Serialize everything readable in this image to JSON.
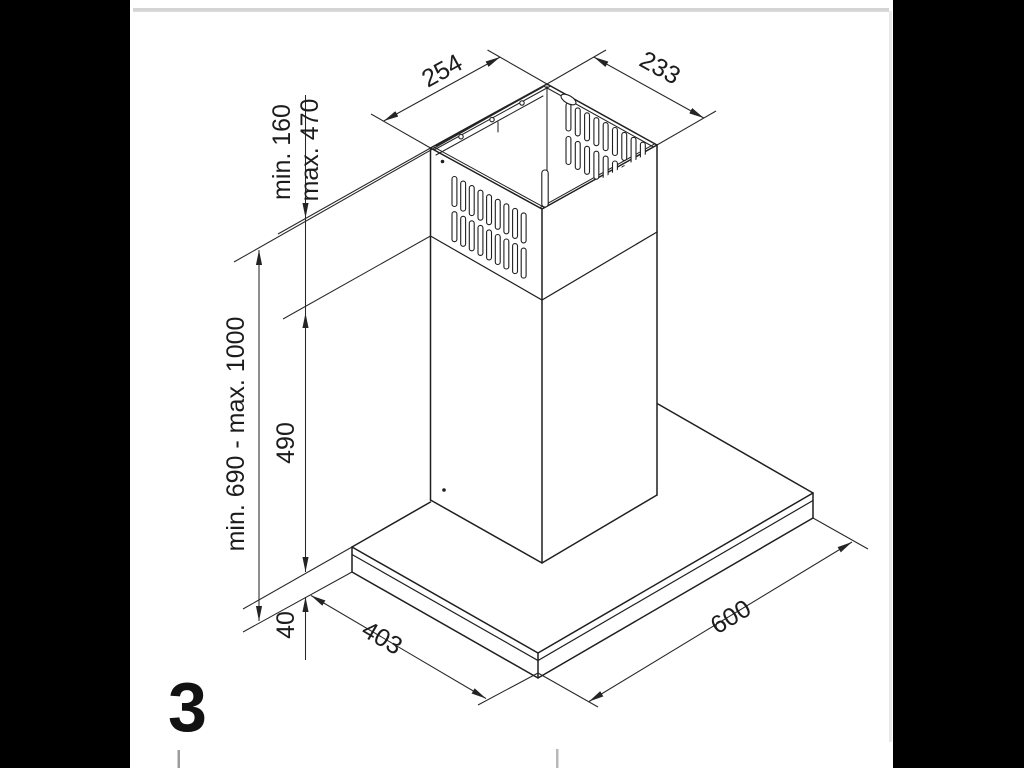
{
  "page": {
    "figure_number": "3",
    "background_color": "#ffffff",
    "side_bar_color": "#000000",
    "top_rule_color": "#d4d4d4",
    "line_color": "#1f1f1f"
  },
  "diagram": {
    "subject": "chimney-cooker-hood-installation-dimensions",
    "dimensions": {
      "chimney_top_width": "254",
      "chimney_top_depth": "233",
      "telescopic_min": "min. 160",
      "telescopic_max": "max. 470",
      "total_height_range": "min. 690 - max. 1000",
      "lower_chimney_height": "490",
      "canopy_thickness": "40",
      "canopy_depth": "403",
      "canopy_width": "600"
    }
  }
}
